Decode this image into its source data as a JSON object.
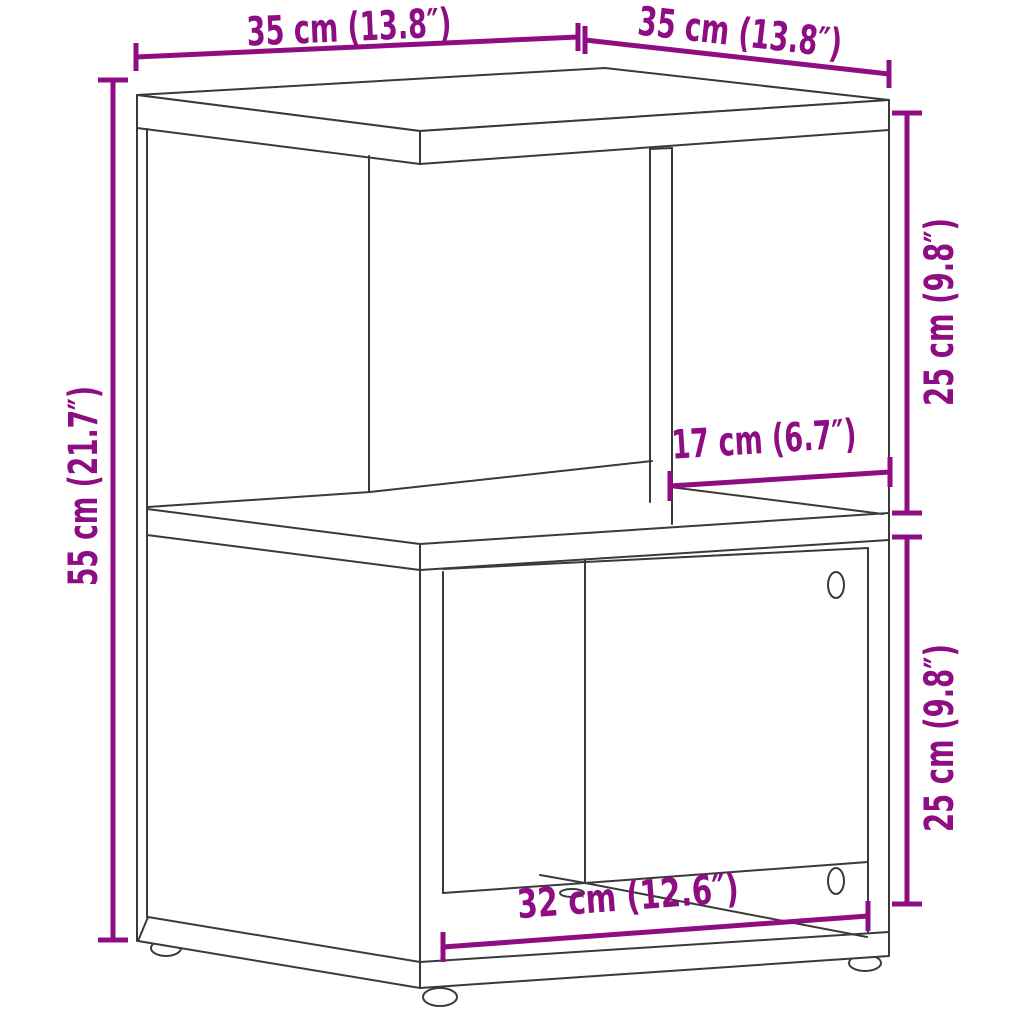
{
  "diagram": {
    "type": "product-dimension-diagram",
    "subject": "two-tier bedside cabinet with offset open compartments, line drawing, three round feet, visible screw holes",
    "background_color": "#ffffff",
    "outline_color": "#3a3a3a",
    "dimension_color": "#8E0D83",
    "dimensions": [
      {
        "id": "top-depth",
        "label": "35 cm (13.8″)",
        "cm": 35,
        "inch": 13.8,
        "placement": "top-left, slanted above top panel"
      },
      {
        "id": "top-width",
        "label": "35 cm (13.8″)",
        "cm": 35,
        "inch": 13.8,
        "placement": "top-right, slanted above top panel"
      },
      {
        "id": "overall-height",
        "label": "55 cm (21.7″)",
        "cm": 55,
        "inch": 21.7,
        "placement": "left side, vertical"
      },
      {
        "id": "upper-compartment-height",
        "label": "25 cm (9.8″)",
        "cm": 25,
        "inch": 9.8,
        "placement": "right side upper, vertical"
      },
      {
        "id": "upper-compartment-width",
        "label": "17 cm (6.7″)",
        "cm": 17,
        "inch": 6.7,
        "placement": "inside upper right compartment, slanted"
      },
      {
        "id": "lower-compartment-height",
        "label": "25 cm (9.8″)",
        "cm": 25,
        "inch": 9.8,
        "placement": "right side lower, vertical"
      },
      {
        "id": "lower-compartment-width",
        "label": "32 cm (12.6″)",
        "cm": 32,
        "inch": 12.6,
        "placement": "bottom, slanted along base"
      }
    ]
  }
}
